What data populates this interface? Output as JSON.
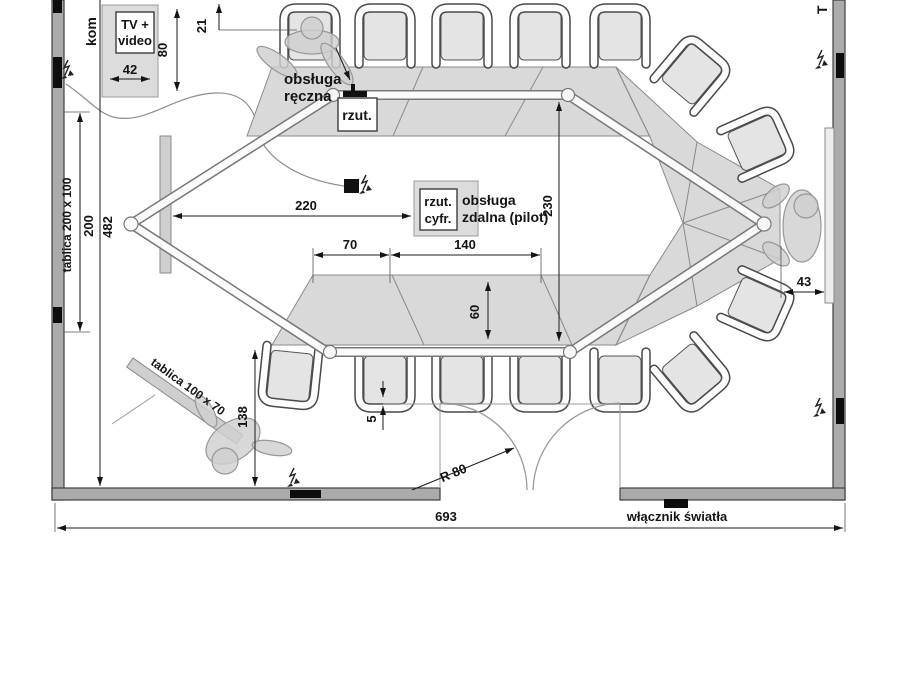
{
  "labels": {
    "kom": "kom",
    "t_right": "T",
    "tv1": "TV +",
    "tv2": "video",
    "obs_reczna1": "obsługa",
    "obs_reczna2": "ręczna",
    "rzut": "rzut.",
    "rzut_cyfr1": "rzut.",
    "rzut_cyfr2": "cyfr.",
    "obs_zdalna1": "obsługa",
    "obs_zdalna2": "zdalna (pilot)",
    "tablica_left": "tablica 200 x 100",
    "tablica_flip": "tablica 100 x 70",
    "wlacznik": "włącznik światła"
  },
  "dims": {
    "d42": "42",
    "d80": "80",
    "d21": "21",
    "d200": "200",
    "d482": "482",
    "d220": "220",
    "d230": "230",
    "d70": "70",
    "d140": "140",
    "d60": "60",
    "d5": "5",
    "d138": "138",
    "d43": "43",
    "d693": "693",
    "r80": "R 80"
  },
  "colors": {
    "table_fill": "#d9d9d9",
    "wall_fill": "#ababab",
    "chair_seat": "#e4e4e4",
    "line_black": "#141414"
  }
}
